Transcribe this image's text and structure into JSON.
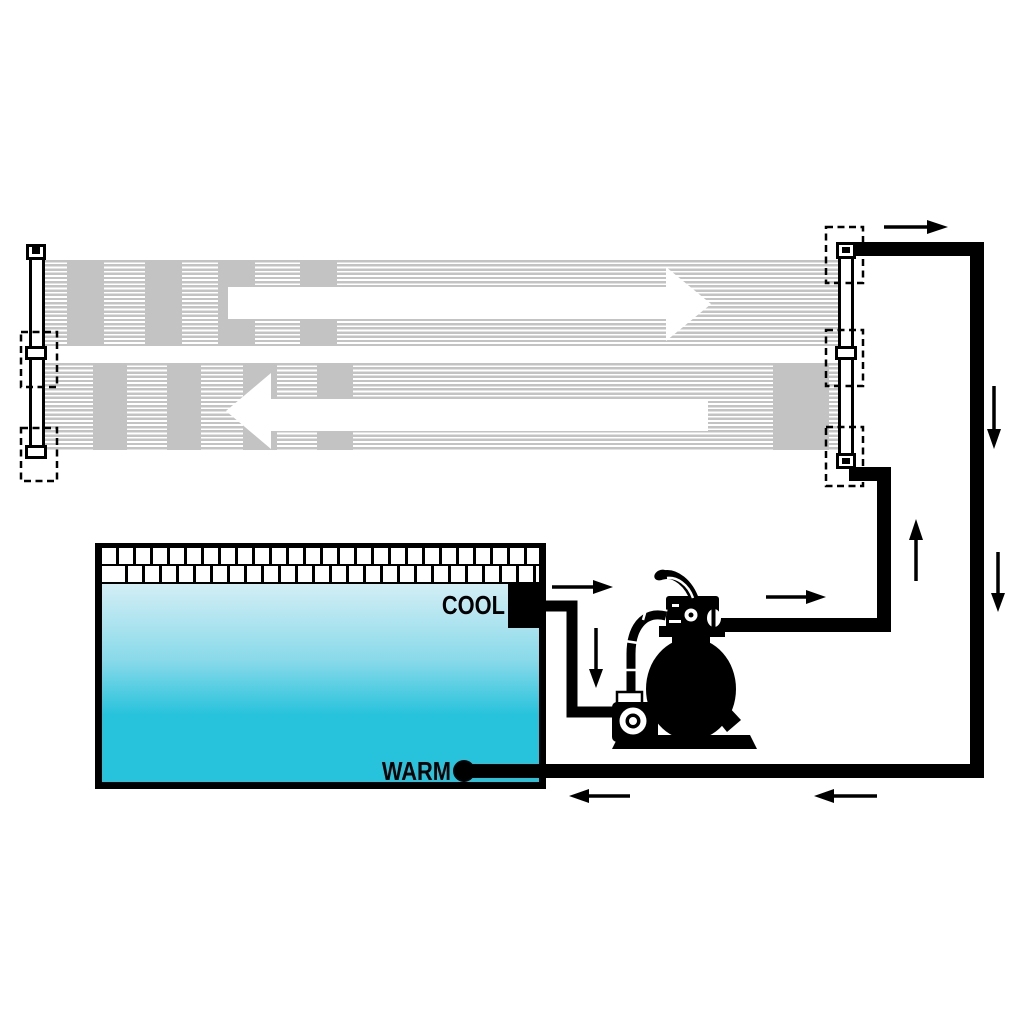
{
  "labels": {
    "cool": "COOL",
    "warm": "WARM"
  },
  "colors": {
    "background": "#ffffff",
    "ink": "#000000",
    "panel_stripe": "#c3c3c3",
    "water_top": "#d3eef5",
    "water_mid": "#8adaea",
    "water_bottom": "#27c3dc"
  },
  "components": {
    "solar_panel": "striped solar collector with left and right manifolds",
    "panel_connector_slots": 5,
    "pool": "tiled swimming pool",
    "pump": "sand filter pump with multiport valve",
    "cool_line": "pool outlet to pump suction",
    "warm_line": "panel return to pool"
  },
  "flow_arrows": [
    {
      "id": "panel-top-row",
      "direction": "right",
      "style": "white"
    },
    {
      "id": "panel-bottom-row",
      "direction": "left",
      "style": "white"
    },
    {
      "id": "panel-outlet",
      "direction": "right",
      "style": "black"
    },
    {
      "id": "return-riser-upper",
      "direction": "down",
      "style": "black"
    },
    {
      "id": "return-riser-lower",
      "direction": "down",
      "style": "black"
    },
    {
      "id": "supply-riser",
      "direction": "up",
      "style": "black"
    },
    {
      "id": "pool-suction",
      "direction": "right",
      "style": "black"
    },
    {
      "id": "suction-drop",
      "direction": "down",
      "style": "black"
    },
    {
      "id": "pump-discharge",
      "direction": "right",
      "style": "black"
    },
    {
      "id": "warm-return-outer",
      "direction": "left",
      "style": "black"
    },
    {
      "id": "warm-return-inner",
      "direction": "left",
      "style": "black"
    }
  ]
}
